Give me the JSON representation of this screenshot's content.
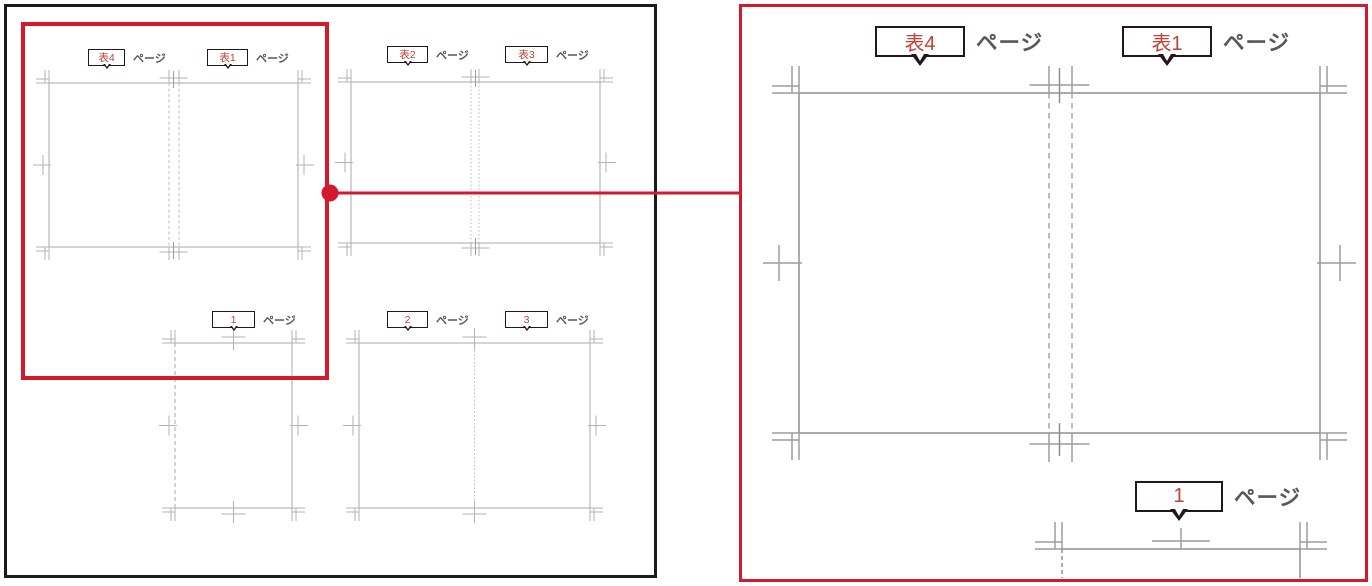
{
  "colors": {
    "accent_red": "#d2192d",
    "label_number_red": "#bf4138",
    "callout_border": "#231815",
    "unit_text_gray": "#595757",
    "line_gray_light": "#a9aaab",
    "line_gray_dark": "#8e8f91",
    "mark_gray_light": "#b2b3b4",
    "mark_gray_dark": "#9c9d9e",
    "panel_border_black": "#1b1b1b"
  },
  "overview_panel": {
    "spreads": [
      {
        "name": "cover-outer-spread",
        "labels": [
          {
            "number": "表4",
            "unit": "ページ"
          },
          {
            "number": "表1",
            "unit": "ページ"
          }
        ]
      },
      {
        "name": "cover-inner-spread",
        "labels": [
          {
            "number": "表2",
            "unit": "ページ"
          },
          {
            "number": "表3",
            "unit": "ページ"
          }
        ]
      },
      {
        "name": "first-page",
        "labels": [
          {
            "number": "1",
            "unit": "ページ"
          }
        ]
      },
      {
        "name": "pages-2-3-spread",
        "labels": [
          {
            "number": "2",
            "unit": "ページ"
          },
          {
            "number": "3",
            "unit": "ページ"
          }
        ]
      }
    ]
  },
  "zoom_panel": {
    "labels": [
      {
        "number": "表4",
        "unit": "ページ"
      },
      {
        "number": "表1",
        "unit": "ページ"
      },
      {
        "number": "1",
        "unit": "ページ"
      }
    ]
  }
}
